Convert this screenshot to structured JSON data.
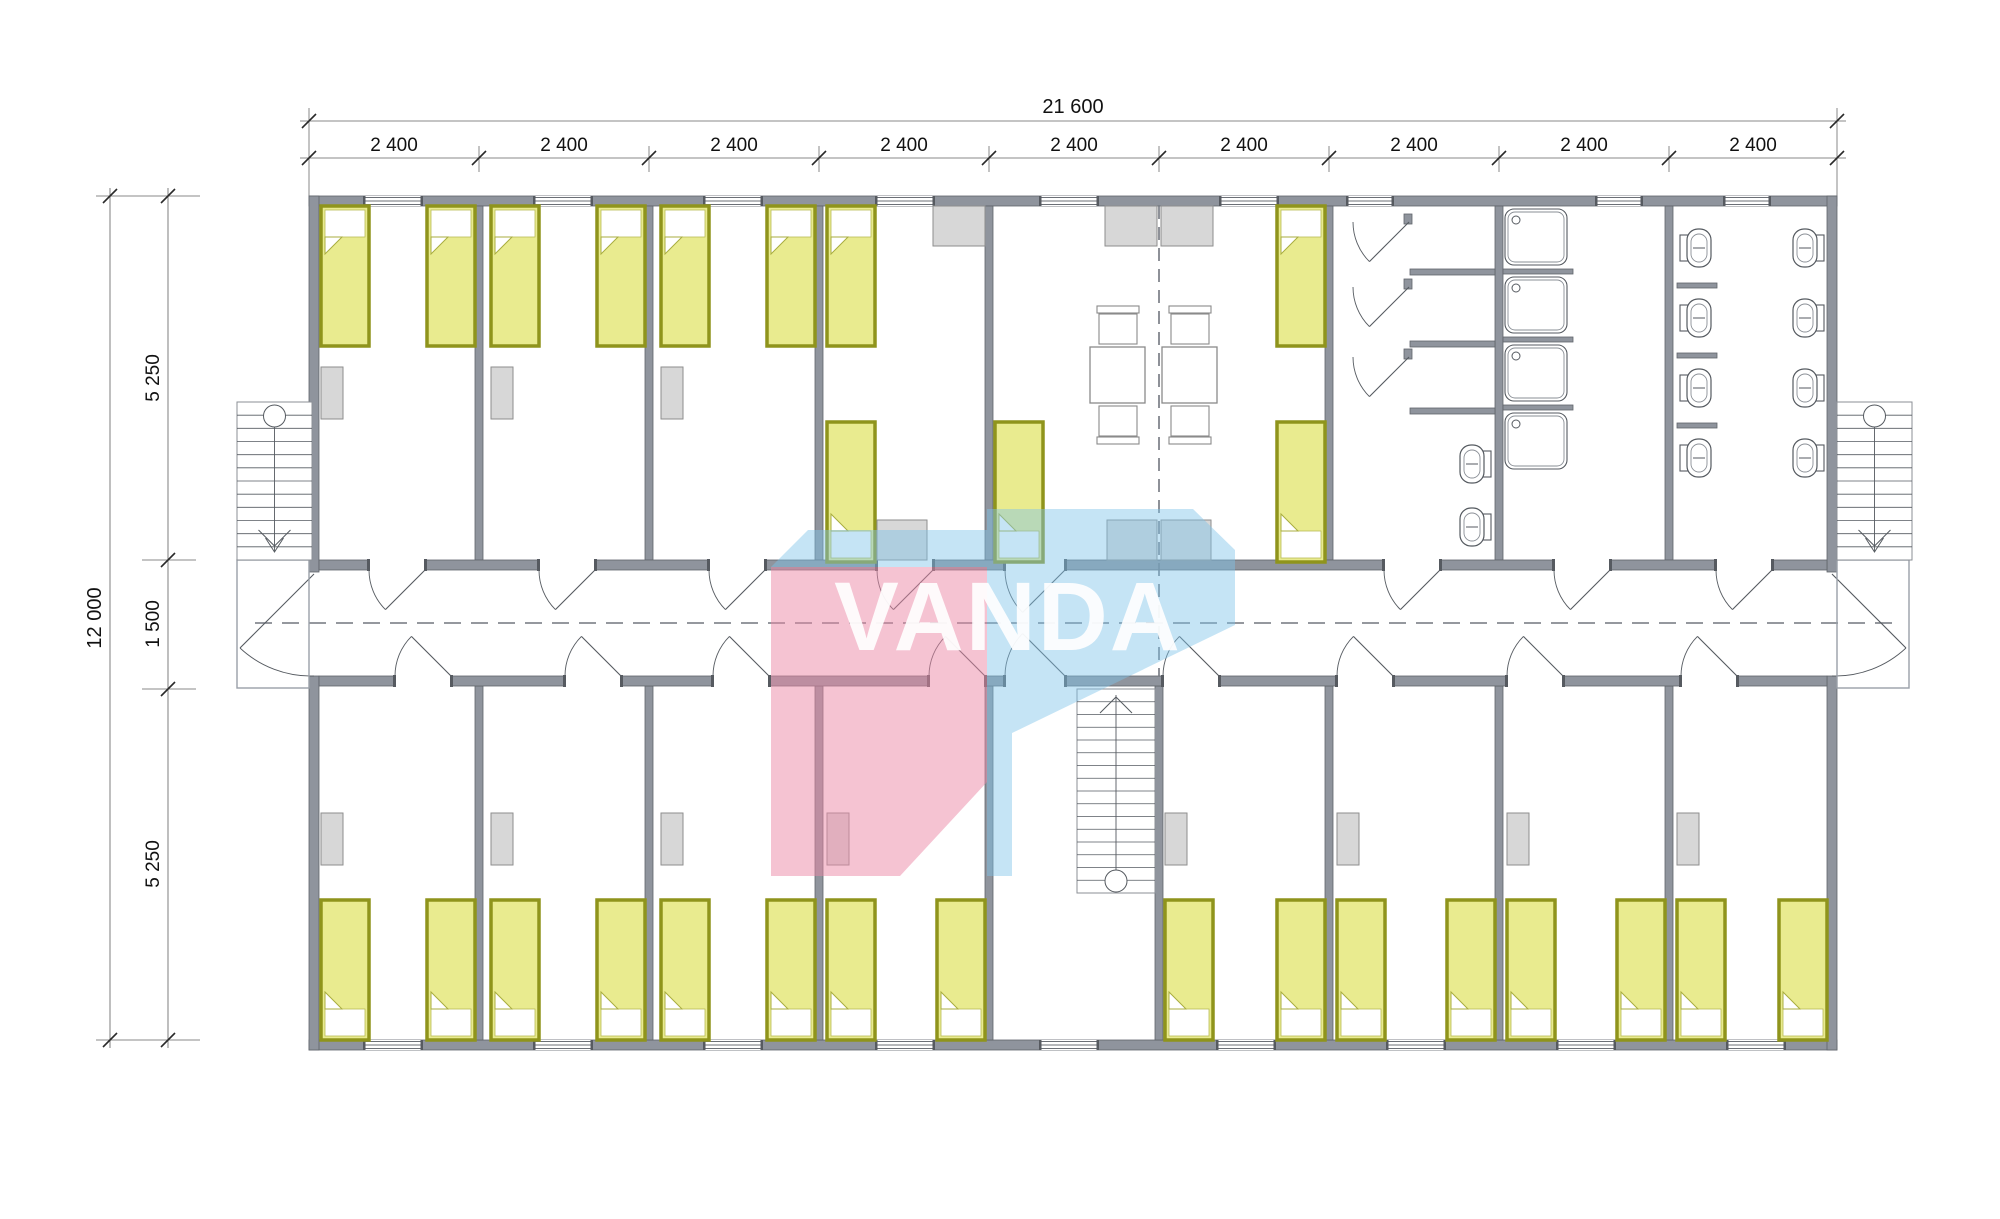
{
  "dimensions": {
    "top": {
      "total": "21 600",
      "segments": [
        "2 400",
        "2 400",
        "2 400",
        "2 400",
        "2 400",
        "2 400",
        "2 400",
        "2 400",
        "2 400"
      ]
    },
    "left": {
      "total": "12 000",
      "segments": [
        "5 250",
        "1 500",
        "5 250"
      ]
    }
  },
  "watermark": {
    "text": "VANDA",
    "pink": "#ec87a5",
    "blue": "#7fc4e8"
  },
  "palette": {
    "wall": "#8f949d",
    "wall_edge": "#60646b",
    "bed_fill": "#e9eb8f",
    "bed_border": "#8f941c",
    "furniture": "#d7d7d7",
    "furniture_edge": "#8e8e8e",
    "fixture_line": "#555a60",
    "dash_line": "#72767e",
    "dim_line": "#8a8a8a",
    "dim_text": "#111111"
  },
  "plan_contents": {
    "single_beds": 27,
    "wardrobes": 11,
    "kitchen_counters": 6,
    "dining_tables": 2,
    "chairs": 4,
    "shower_cabins": 3,
    "shower_trays": 4,
    "toilets": 10,
    "staircases_exterior": 2,
    "staircases_interior": 1,
    "corridor": 1
  }
}
